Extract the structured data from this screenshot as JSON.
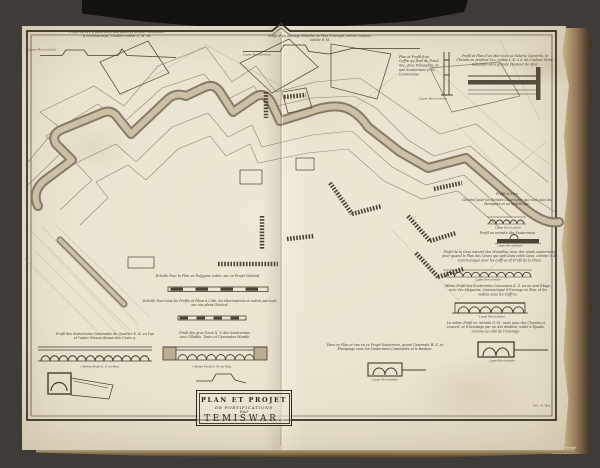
{
  "colors": {
    "background": "#3f3c38",
    "paper": "#e9e3d0",
    "ink": "#3e372a",
    "rampart_band": "#cbc0a5",
    "page_edge_tan": "#c3ae87",
    "page_edge_brown": "#6e5a3e",
    "cloth_black": "#14120f"
  },
  "cartouche": {
    "line1": "PLAN ET PROJET",
    "line2": "DE FORTIFICATIONS",
    "line3": "Pour",
    "line4": "TEMISWAR."
  },
  "labels": {
    "ligne_horizontale": "Ligne Horizontale",
    "signature": "Fec: A. Hm."
  },
  "scales": {
    "plan": "Echelle Pour le Plan en Polygone entier, sur ce Projet Général.",
    "profils": "Echelle Pour tous les Profils et Plans à Côté, les observations et autres par tout, sur ces plans Général."
  },
  "annotations": {
    "top_left_1": "Profil du Terre plein avec Murailles et devant l'Enceinte,",
    "top_left_2": "à Contrescarpe, Couleur cottée G. M. M.",
    "top_center_1": "Profil d'un ouvrage détaché au Plan Principal, même Couleur,",
    "top_center_2": "Cottée F. M.",
    "coffre": "Plan et Profil d'un Coffre au fond du Fossé Sec, avec Palissades, et une Souterraine p. la Contremine.",
    "top_right": "Profil et Plan d'un Mur avec sa Galerie Couverte, le Chemin en profond Sec, cottée I. K. à S. de Couleur Verte, Palissadé sans grande Hauteur de Mur.",
    "right_head": "Profil et Plan",
    "right_head_2": "Général pour les Rondes Casemates qui vont sous les Remparts et un seul Étage.",
    "right_retraite": "Profil en retraite des Souterrains.",
    "right_cave": "Profil de la Cave naturel des Murailles, avec des ronds souterrains, pour quand le Plan des Caves qui sont dans cette Cave, comme V. X., Communiqué avec les Coffres et Profil de la Place.",
    "right_meme": "Même Profil des Souterrains Casemates K. S. en un seul Étage, avec des Magazins, Communiqué d'Ouvrage en Eau, et les voûtes sous les Coffres.",
    "right_gh": "Le même Profil en retraite G. H., mais avec des Chemins à couvert, et d'avantage par un des doubles, voûté à Épaule, comme au côté de l'Ouvrage.",
    "bottom_left_1": "Profil des Souterrains Casematés du Quartier K. K. en l'un",
    "bottom_left_2": "et l'autre Niveau dessus des Caves p.",
    "bottom_left_sub": "† Même Profil K. F. en Plan.",
    "bottom_center_1": "Profil des gros Tours X. V. des Souterrains,",
    "bottom_center_2": "avec l'Étable, Tours et Casemates Murale.",
    "bottom_center_sub": "† Même Profil X. W. en Plan.",
    "bottom_right": "Dans ce Plan et vue en ce Projet Souterrain, grand Casemate W. X. et Flanquage sous les Souterrains Casematés et le Bastion."
  }
}
